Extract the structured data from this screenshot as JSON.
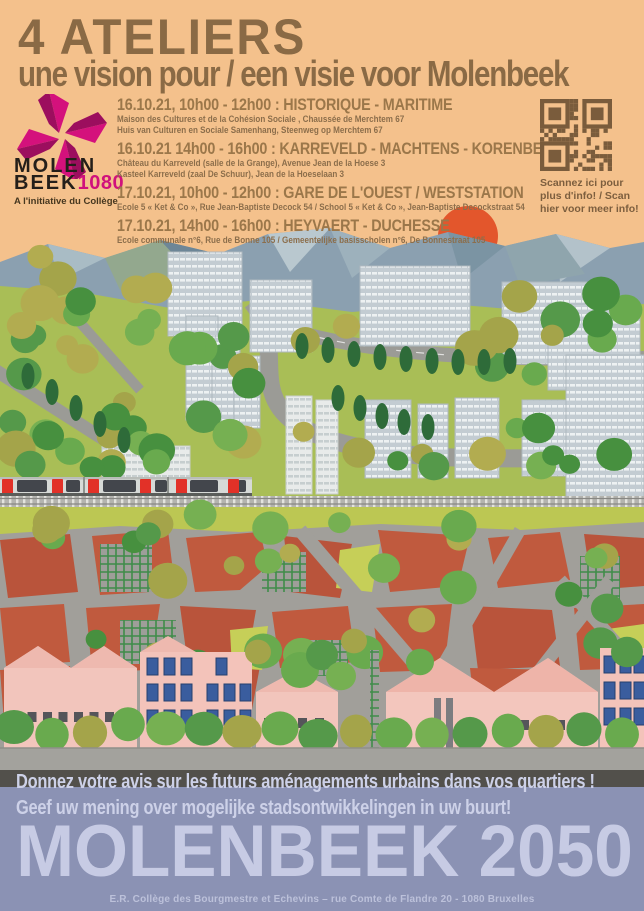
{
  "poster": {
    "title": "4 ATELIERS",
    "subtitle": "une vision pour / een visie voor Molenbeek"
  },
  "logo": {
    "line1": "MOLEN",
    "line2": "BEEK",
    "number": "1080",
    "tagline": "A l'initiative du Collège",
    "icon": "pinwheel-icon"
  },
  "events": [
    {
      "title": "16.10.21, 10h00 - 12h00 : HISTORIQUE - MARITIME",
      "lines": [
        "Maison des Cultures et de la Cohésion Sociale , Chaussée de Merchtem 67",
        "Huis van Culturen en Sociale Samenhang, Steenweg op Merchtem 67"
      ]
    },
    {
      "title": "16.10.21 14h00 - 16h00 : KARREVELD - MACHTENS - KORENBEEK",
      "lines": [
        "Château du Karreveld (salle de la Grange), Avenue Jean de la Hoese 3",
        "Kasteel Karreveld (zaal De Schuur), Jean de la Hoeselaan 3"
      ]
    },
    {
      "title": "17.10.21, 10h00 - 12h00 : GARE DE L'OUEST / WESTSTATION",
      "lines": [
        "Ecole 5 « Ket & Co », Rue Jean-Baptiste Decock 54 / School 5 « Ket & Co », Jean-Baptiste Decockstraat 54"
      ]
    },
    {
      "title": "17.10.21, 14h00 - 16h00 : HEYVAERT - DUCHESSE",
      "lines": [
        "Ecole communale n°6, Rue de Bonne 105 / Gemeentelijke basisscholen n°6, De Bonnestraat 105"
      ]
    }
  ],
  "qr": {
    "icon": "qr-code-icon",
    "caption": "Scannez ici pour plus d'info! / Scan hier voor meer info!"
  },
  "banner": {
    "line_fr": "Donnez votre avis sur les futurs aménagements urbains dans vos quartiers !",
    "line_nl": "Geef uw mening over mogelijke stadsontwikkelingen in uw buurt!",
    "big_title": "MOLENBEEK 2050",
    "footer": "E.R. Collège des Bourgmestre et Echevins – rue Comte de Flandre 20 - 1080 Bruxelles"
  },
  "colors": {
    "background_peach": "#f4c18c",
    "ink_brown": "#8a6a45",
    "heading_brown": "#9b774a",
    "magenta": "#d0117c",
    "sun_orange": "#e3562c",
    "field_green": "#a9be56",
    "mountain_blue": "#8ba0b0",
    "block_red": "#c05a3e",
    "house_pink": "#f3c5bc",
    "street_gray": "#a19f9a",
    "train_door_red": "#e23128",
    "banner_blue": "#8b92b4",
    "banner_text": "#cdd1e8",
    "dark_strip": "#52504b"
  }
}
